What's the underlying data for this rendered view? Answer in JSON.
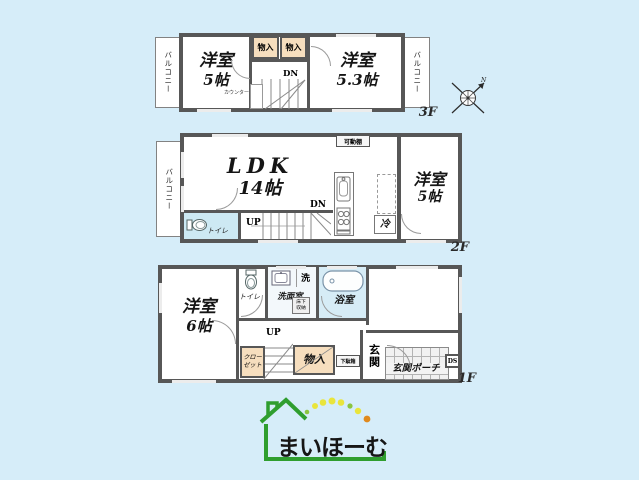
{
  "colors": {
    "background": "#d6edf9",
    "wall": "#575757",
    "closet_fill": "#f6debe",
    "wet_room_fill": "#d6ecf6",
    "toilet_fill": "#cde9f3",
    "logo_green": "#2f9e2f",
    "logo_yellow": "#e9e53c",
    "logo_orange": "#e08a1e"
  },
  "floor3": {
    "label": "3F",
    "balcony_left": "バルコニー",
    "balcony_right": "バルコニー",
    "room_left_name": "洋室",
    "room_left_size": "5帖",
    "room_right_name": "洋室",
    "room_right_size": "5.3帖",
    "closet_left": "物入",
    "closet_right": "物入",
    "stair_dn": "DN",
    "counter_label": "カウンター"
  },
  "floor2": {
    "label": "2F",
    "balcony_left": "バルコニー",
    "ldk_name": "LDK",
    "ldk_size": "14帖",
    "shelf_label": "可動棚",
    "room_right_name": "洋室",
    "room_right_size": "5帖",
    "fridge_label": "冷",
    "toilet_label": "トイレ",
    "stair_up": "UP",
    "stair_dn": "DN"
  },
  "floor1": {
    "label": "1F",
    "room_name": "洋室",
    "room_size": "6帖",
    "toilet_label": "トイレ",
    "washroom_label": "洗面室",
    "underfloor_line1": "床下",
    "underfloor_line2": "収納",
    "washer_label": "洗",
    "bath_label": "浴室",
    "closet_line1": "クロー",
    "closet_line2": "ゼット",
    "storage_label": "物入",
    "shoebox_label": "下駄箱",
    "entrance_label": "玄関",
    "porch_label": "玄関ポーチ",
    "duct_label": "DS",
    "stair_up": "UP"
  },
  "compass": {
    "north_label": "N"
  },
  "logo": {
    "text": "まいほーむ"
  }
}
